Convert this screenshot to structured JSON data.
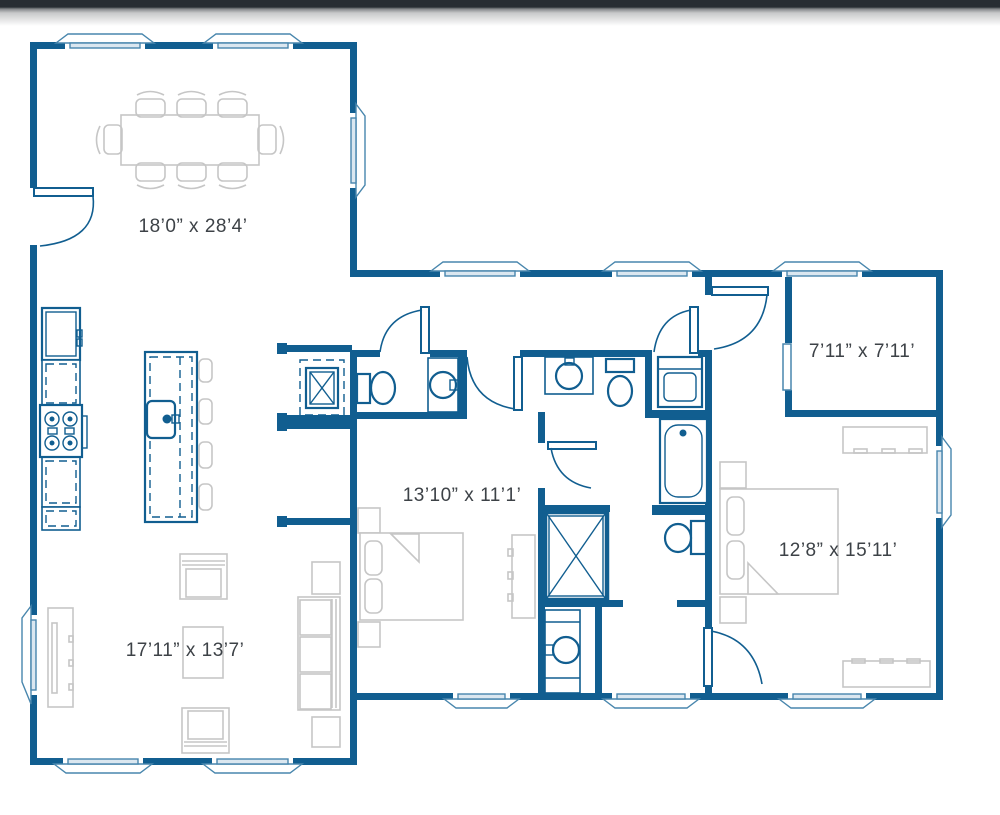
{
  "theme": {
    "wall_color": "#115e90",
    "accent_light": "#4886ad",
    "furniture_color": "#c6c6c6",
    "label_color": "#3d4247",
    "topbar_color": "#282d33",
    "background": "#ffffff"
  },
  "rooms": [
    {
      "id": "great-room",
      "dimensions": "18’0” x 28’4’"
    },
    {
      "id": "closet",
      "dimensions": "7’11” x 7’11’"
    },
    {
      "id": "bedroom-2",
      "dimensions": "13’10” x 11’1’"
    },
    {
      "id": "master-bedroom",
      "dimensions": "12’8” x 15’11’"
    },
    {
      "id": "living-room",
      "dimensions": "17’11” x 13’7’"
    }
  ]
}
